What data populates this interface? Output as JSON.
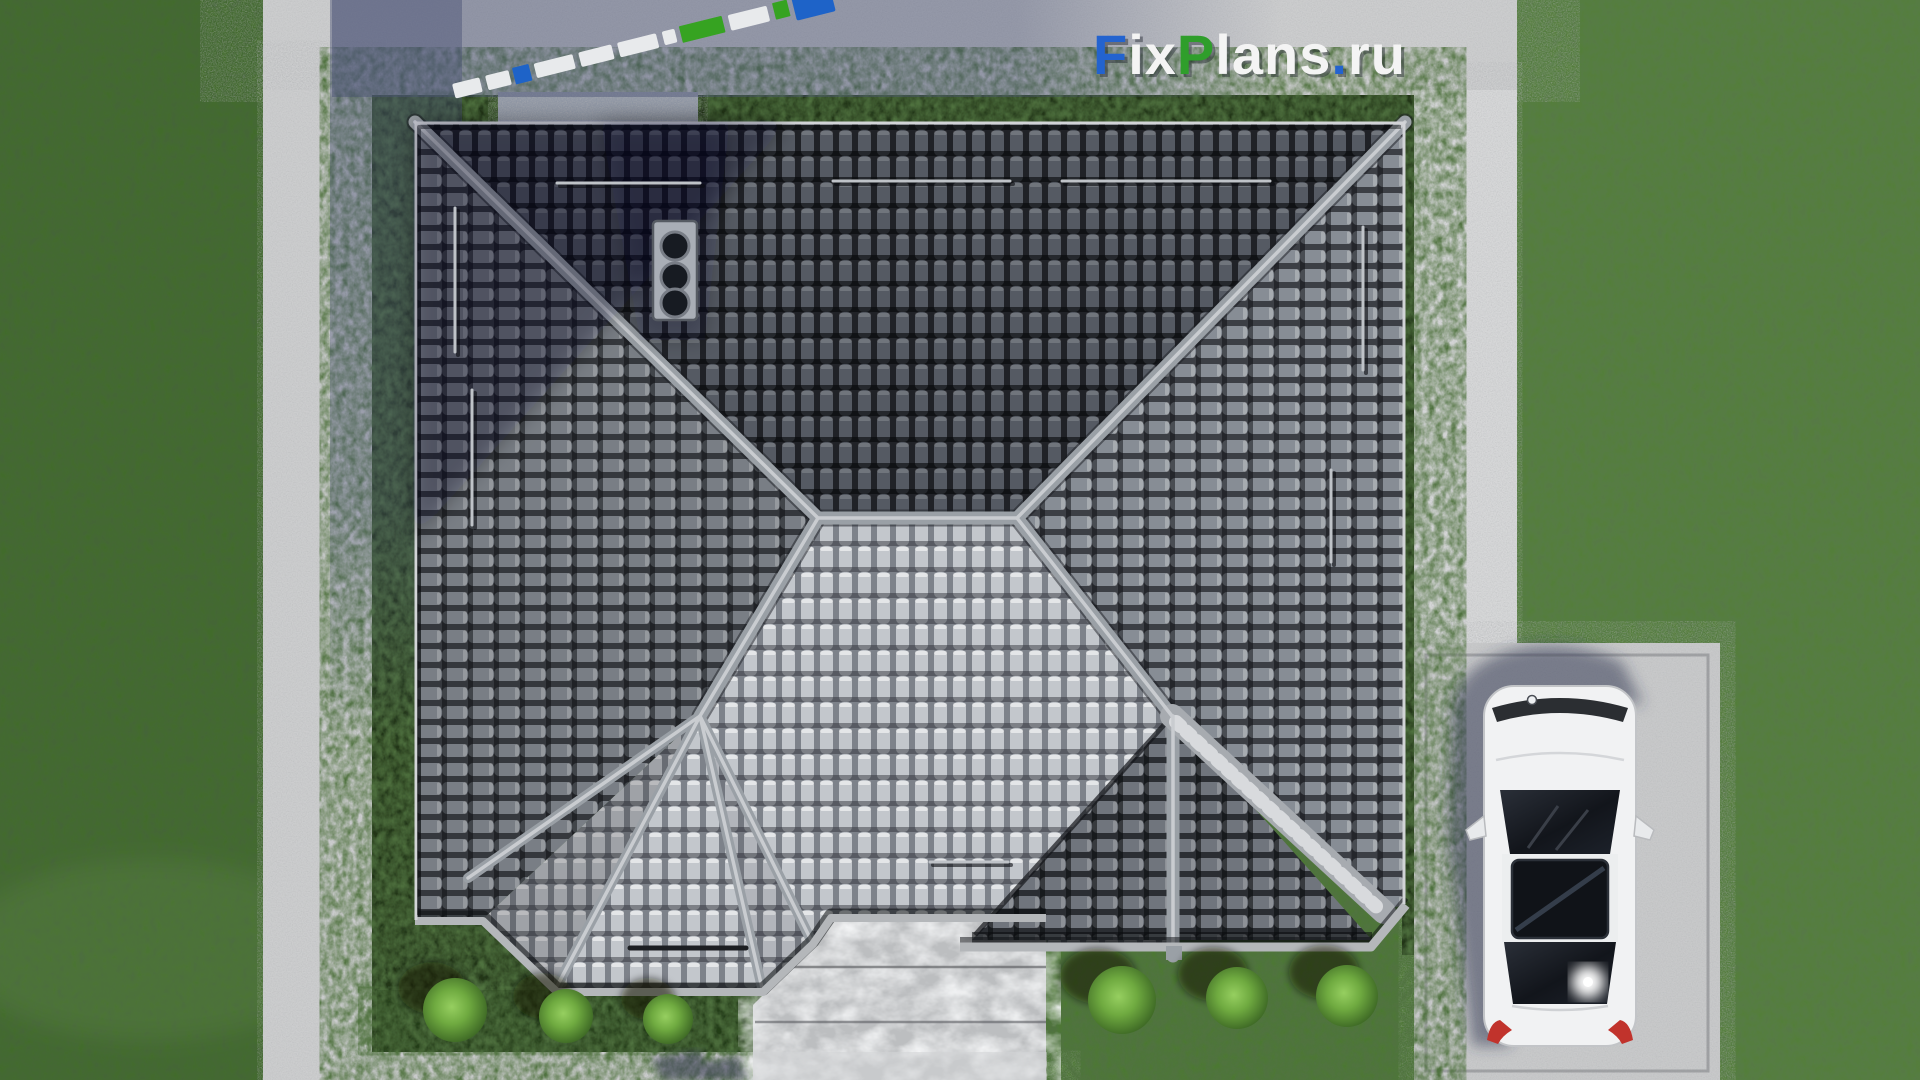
{
  "watermark": {
    "f": "F",
    "ix": "ix",
    "p": "P",
    "lans": "lans",
    "dot": ".",
    "ru": "ru"
  },
  "palette": {
    "logo_blue": "#2363cf",
    "logo_green": "#2f9e2b",
    "logo_white": "#f4f4f4",
    "grass_base": "#4c7833",
    "yard_green": "#223618",
    "hedge_green": "#243d19",
    "concrete": "#cccdce",
    "concrete_bright": "#d6d7d8",
    "driveway": "#c8c9ca",
    "marble_walkway": "#bcbec0",
    "ridge_gray": "#9aa0a6",
    "ridge_highlight": "#c9ccd0",
    "fascia_gray": "#b4b7ba",
    "valley_gray": "#a7abb0",
    "chimney_gray": "#a9aeb6",
    "flue_dark": "#171b22",
    "porch_pad": "#9198a6",
    "bush_green": "#79b549",
    "bush_shadow": "rgba(12,24,6,0.55)",
    "shadow_tint": "rgba(72,80,116,0.42)",
    "car_body": "#f1f2f3",
    "car_glass": "#15181e",
    "car_taillight": "#c1332c",
    "strip_white": "#e8eaec",
    "strip_green": "#36a321",
    "strip_blue": "#1e63c8"
  }
}
